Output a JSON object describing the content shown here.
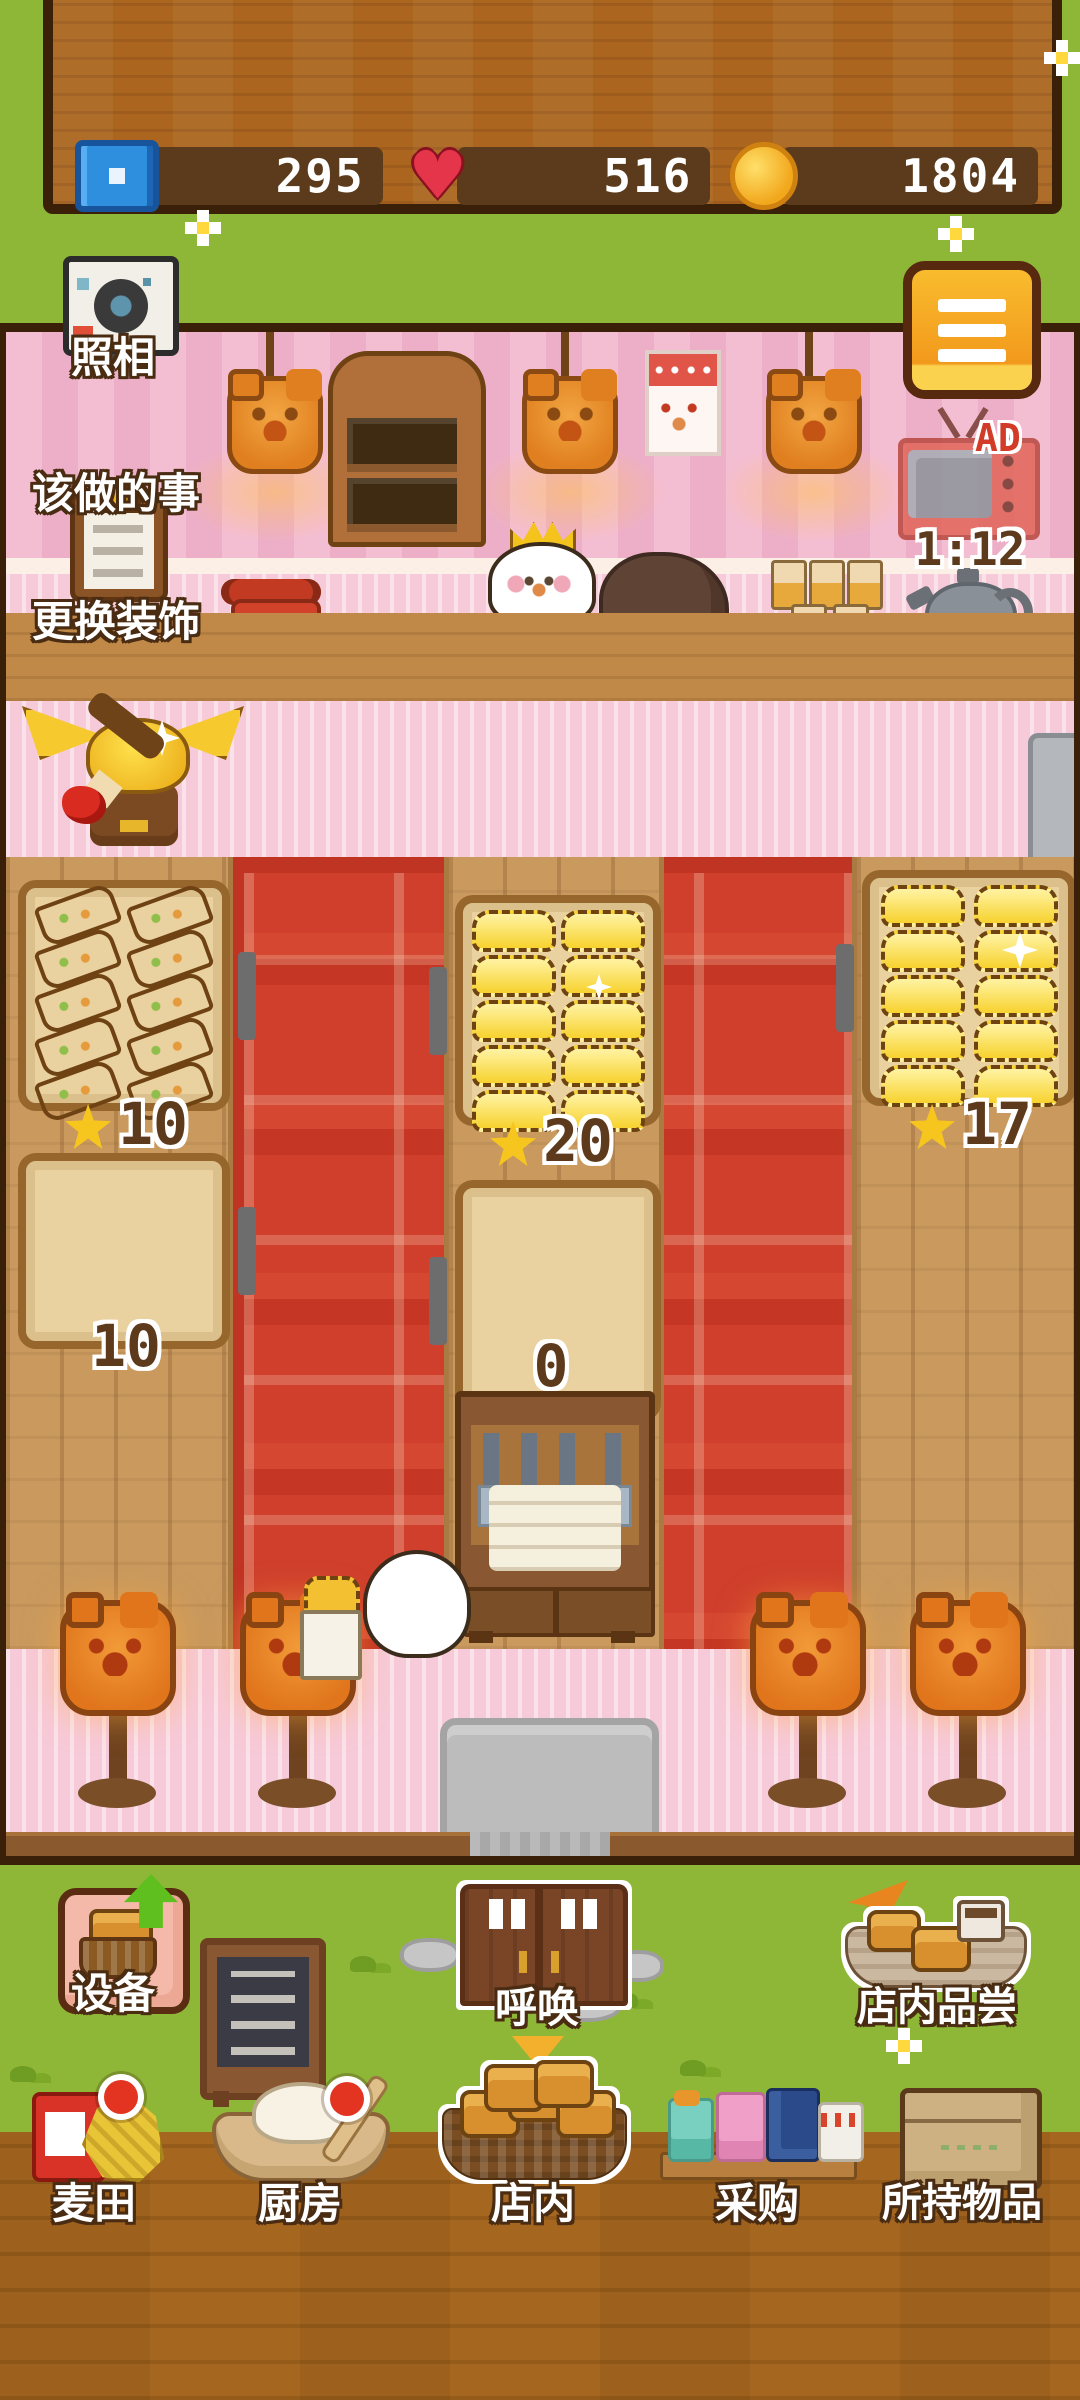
{
  "stats": {
    "tickets": "295",
    "hearts": "516",
    "coins": "1804"
  },
  "side_buttons": {
    "photo": "照相",
    "todo": "该做的事",
    "decorate": "更换装饰"
  },
  "ad_tv": {
    "badge": "AD",
    "timer": "1:12"
  },
  "counters": {
    "left_display_stars": "10",
    "left_prep_count": "10",
    "center_display_stars": "20",
    "center_prep_count": "0",
    "right_display_stars": "17"
  },
  "shop_items": {
    "left_table_item": "sandwich",
    "left_table_count": 10,
    "center_table_item": "muffin",
    "center_table_count": 10,
    "right_table_item": "muffin",
    "right_table_count": 10
  },
  "nav_row1": {
    "equipment": "设备",
    "call": "呼唤",
    "tasting": "店内品尝"
  },
  "nav_row2": {
    "wheat_field": "麦田",
    "kitchen": "厨房",
    "in_store": "店内",
    "purchase": "采购",
    "inventory": "所持物品"
  },
  "colors": {
    "grass": "#8fb737",
    "wall_pink": "#f4bed2",
    "carpet_red": "#cf3f2c",
    "wood_sign": "#ab651f",
    "menu_orange": "#f5a623",
    "badge_red": "#e23420",
    "pill_brown": "#5b3b1b"
  }
}
